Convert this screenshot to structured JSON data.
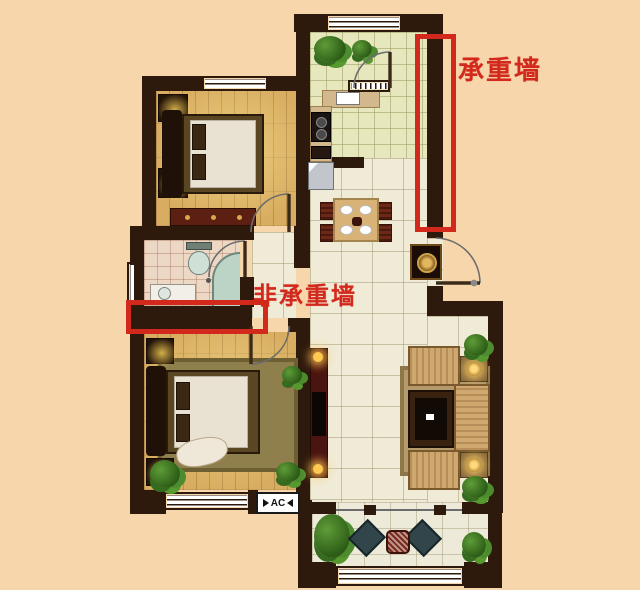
{
  "annotations": {
    "load_bearing": {
      "label": "承重墙",
      "color": "#d2291c"
    },
    "non_load_bearing": {
      "label": "非承重墙",
      "color": "#d2291c"
    }
  },
  "labels": {
    "ac": "AC"
  },
  "palette": {
    "background": "#f8d6ac",
    "wall": "#2e190d",
    "annotation_red": "#d2291c",
    "wood_floor": "#d8ad61",
    "living_tile": "#f0ebd6",
    "kitchen_tile": "#e7e7bd",
    "bath_tile": "#edd8c6"
  }
}
